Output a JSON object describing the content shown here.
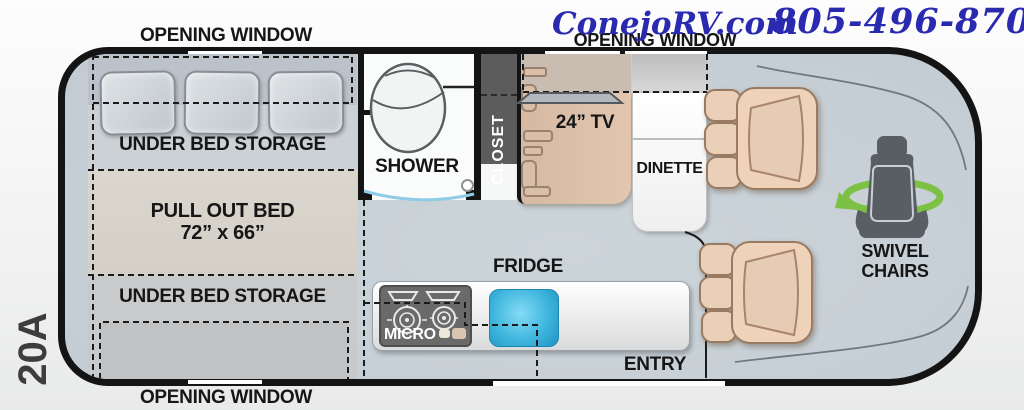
{
  "header": {
    "site": "ConejoRV.com",
    "phone": "805-496-8700"
  },
  "model": "20A",
  "rooms": {
    "opening_window": "OPENING WINDOW",
    "under_bed_storage": "UNDER BED STORAGE",
    "pull_out_bed": "PULL OUT BED",
    "pull_out_bed_size": "72” x 66”",
    "shower": "SHOWER",
    "closet": "CLOSET",
    "tv": "24” TV",
    "dinette": "DINETTE",
    "swivel_chairs_line1": "SWIVEL",
    "swivel_chairs_line2": "CHAIRS",
    "fridge": "FRIDGE",
    "micro": "MICRO",
    "entry": "ENTRY"
  },
  "colors": {
    "accent_blue": "#2a2ab0",
    "floor": "#c9d2d8",
    "outline_black": "#141414",
    "cabinet_tan": "#dfc3ad",
    "seat_tan": "#eed3ba",
    "closet_gray": "#5c5c5c",
    "sink_blue": "#2ba6d4",
    "swivel_green": "#7cc143"
  }
}
